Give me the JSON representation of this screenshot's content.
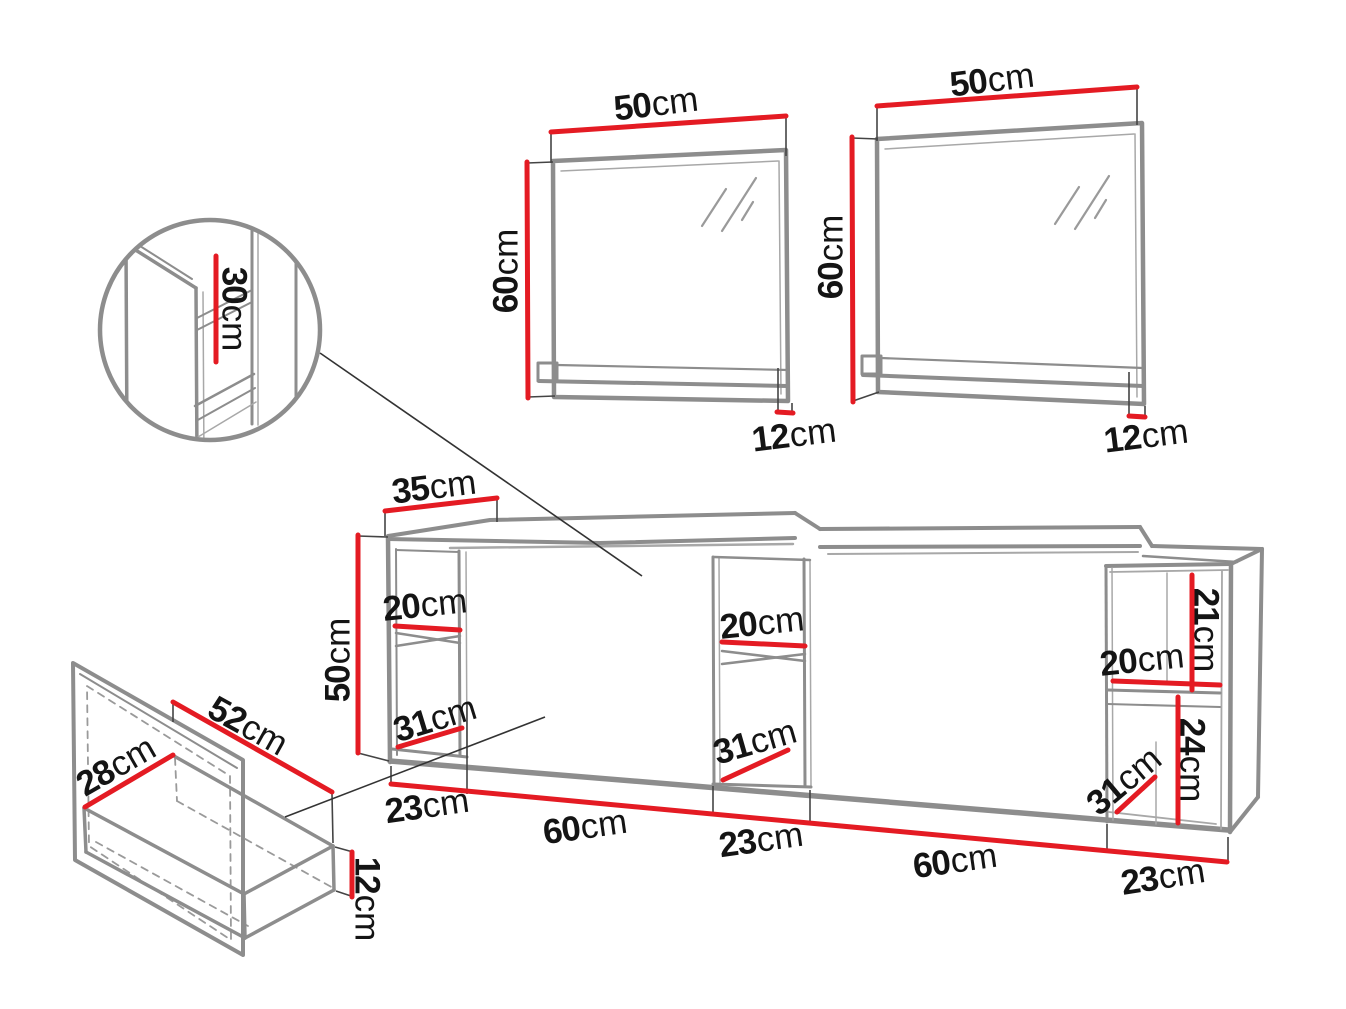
{
  "diagram": {
    "kind": "furniture-dimension-diagram",
    "subject": "Bathroom vanity set: two wall mirrors with shelves, a long wall-hung vanity cabinet with open shelf niches, an interior detail circle and a drawer detail",
    "components": [
      "mirror-with-shelf-left",
      "mirror-with-shelf-right",
      "interior-detail-circle",
      "vanity-cabinet",
      "drawer-detail"
    ]
  },
  "colors": {
    "dimension_red": "#e41b23",
    "line_gray": "#8d8d8d",
    "line_light_gray": "#a8a8a8",
    "callout_black": "#333333",
    "text_black": "#141414",
    "background": "#ffffff"
  },
  "dimensions": [
    {
      "id": "mirror-left-width",
      "component": "mirror-left",
      "value": "50",
      "unit": "cm",
      "x": 656,
      "y": 104,
      "rot": -7
    },
    {
      "id": "mirror-left-height",
      "component": "mirror-left",
      "value": "60",
      "unit": "cm",
      "x": 506,
      "y": 271,
      "rot": -90
    },
    {
      "id": "mirror-left-shelf",
      "component": "mirror-left",
      "value": "12",
      "unit": "cm",
      "x": 794,
      "y": 435,
      "rot": -7
    },
    {
      "id": "mirror-right-width",
      "component": "mirror-right",
      "value": "50",
      "unit": "cm",
      "x": 992,
      "y": 80,
      "rot": -7
    },
    {
      "id": "mirror-right-height",
      "component": "mirror-right",
      "value": "60",
      "unit": "cm",
      "x": 831,
      "y": 257,
      "rot": -90
    },
    {
      "id": "mirror-right-shelf",
      "component": "mirror-right",
      "value": "12",
      "unit": "cm",
      "x": 1146,
      "y": 436,
      "rot": -7
    },
    {
      "id": "detail-depth",
      "component": "detail-circle",
      "value": "30",
      "unit": "cm",
      "x": 234,
      "y": 309,
      "rot": 90
    },
    {
      "id": "cabinet-top-depth",
      "component": "cabinet",
      "value": "35",
      "unit": "cm",
      "x": 434,
      "y": 487,
      "rot": -7
    },
    {
      "id": "cabinet-height",
      "component": "cabinet",
      "value": "50",
      "unit": "cm",
      "x": 338,
      "y": 660,
      "rot": -90
    },
    {
      "id": "niche-left-width",
      "component": "cabinet",
      "value": "20",
      "unit": "cm",
      "x": 425,
      "y": 605,
      "rot": -6
    },
    {
      "id": "niche-left-depth",
      "component": "cabinet",
      "value": "31",
      "unit": "cm",
      "x": 435,
      "y": 719,
      "rot": -17
    },
    {
      "id": "niche-mid-width",
      "component": "cabinet",
      "value": "20",
      "unit": "cm",
      "x": 762,
      "y": 623,
      "rot": -6
    },
    {
      "id": "niche-mid-depth",
      "component": "cabinet",
      "value": "31",
      "unit": "cm",
      "x": 755,
      "y": 742,
      "rot": -16
    },
    {
      "id": "niche-right-upper-h",
      "component": "cabinet",
      "value": "21",
      "unit": "cm",
      "x": 1206,
      "y": 630,
      "rot": 90
    },
    {
      "id": "niche-right-width",
      "component": "cabinet",
      "value": "20",
      "unit": "cm",
      "x": 1142,
      "y": 660,
      "rot": -6
    },
    {
      "id": "niche-right-lower-h",
      "component": "cabinet",
      "value": "24",
      "unit": "cm",
      "x": 1192,
      "y": 760,
      "rot": 90
    },
    {
      "id": "niche-right-depth",
      "component": "cabinet",
      "value": "31",
      "unit": "cm",
      "x": 1124,
      "y": 781,
      "rot": -40
    },
    {
      "id": "bottom-seg-1",
      "component": "cabinet-bottom",
      "value": "23",
      "unit": "cm",
      "x": 427,
      "y": 806,
      "rot": -8
    },
    {
      "id": "bottom-seg-2",
      "component": "cabinet-bottom",
      "value": "60",
      "unit": "cm",
      "x": 585,
      "y": 827,
      "rot": -8
    },
    {
      "id": "bottom-seg-3",
      "component": "cabinet-bottom",
      "value": "23",
      "unit": "cm",
      "x": 761,
      "y": 840,
      "rot": -8
    },
    {
      "id": "bottom-seg-4",
      "component": "cabinet-bottom",
      "value": "60",
      "unit": "cm",
      "x": 955,
      "y": 861,
      "rot": -8
    },
    {
      "id": "bottom-seg-5",
      "component": "cabinet-bottom",
      "value": "23",
      "unit": "cm",
      "x": 1163,
      "y": 877,
      "rot": -9
    },
    {
      "id": "drawer-width",
      "component": "drawer",
      "value": "28",
      "unit": "cm",
      "x": 116,
      "y": 766,
      "rot": -30
    },
    {
      "id": "drawer-depth",
      "component": "drawer",
      "value": "52",
      "unit": "cm",
      "x": 248,
      "y": 726,
      "rot": 29
    },
    {
      "id": "drawer-height",
      "component": "drawer",
      "value": "12",
      "unit": "cm",
      "x": 367,
      "y": 899,
      "rot": 90
    }
  ]
}
